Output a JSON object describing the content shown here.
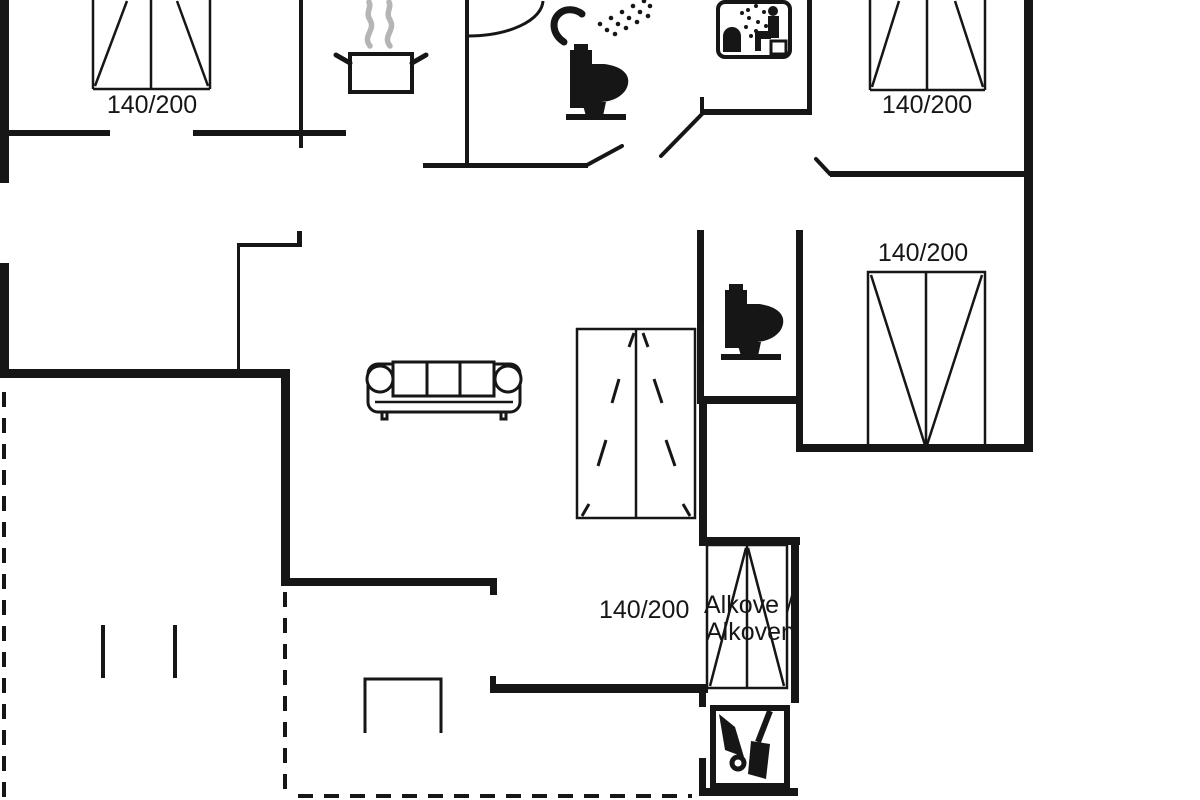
{
  "plan": {
    "background_color": "#ffffff",
    "line_color": "#161616",
    "steam_color": "#b5b5b5",
    "labels": {
      "bed_top_left": "140/200",
      "bed_top_right": "140/200",
      "bed_right": "140/200",
      "bed_alcove_size": "140/200",
      "alcove_name_line1": "Alkove /",
      "alcove_name_line2": "Alkoven"
    },
    "icons": {
      "cooking_pot": "pot-with-steam",
      "shower": "shower-head-with-spray-dots",
      "toilet_bathroom": "toilet-side-silhouette",
      "toilet_wc": "toilet-side-silhouette",
      "sauna": "sauna-box-with-person-and-steam",
      "sofa": "three-seat-sofa",
      "shed_tools": "wheelbarrow-and-shovel-in-shed",
      "beds": "double-bed-140x200-symbol"
    }
  }
}
